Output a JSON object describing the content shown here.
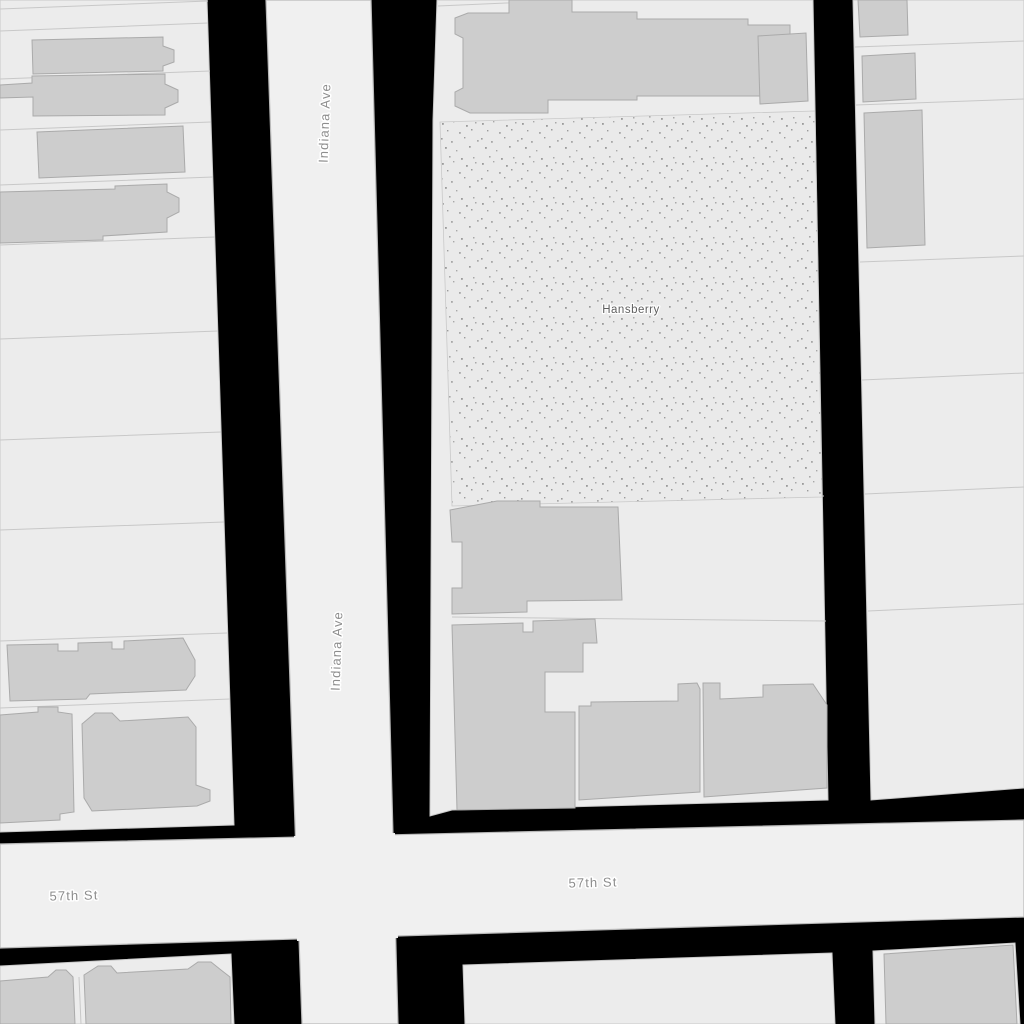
{
  "map": {
    "street_labels": [
      {
        "id": "indiana-ave-upper",
        "text": "Indiana Ave"
      },
      {
        "id": "indiana-ave-lower",
        "text": "Indiana Ave"
      },
      {
        "id": "57th-st-west",
        "text": "57th St"
      },
      {
        "id": "57th-st-east",
        "text": "57th St"
      }
    ],
    "park_label": {
      "text": "Hansberry"
    },
    "colors": {
      "background": "#000000",
      "road_fill": "#f0f0f0",
      "road_casing": "#b9b9b9",
      "block_fill": "#ececec",
      "block_border": "#c9c9c9",
      "parcel_line": "#c8c8c8",
      "building_fill": "#cdcdcd",
      "building_border": "#aaaaaa",
      "park_fill": "#eaeaea",
      "park_dot": "#9b9b9b",
      "street_label_color": "#8d8d8d",
      "park_label_color": "#5f5f5f"
    }
  }
}
